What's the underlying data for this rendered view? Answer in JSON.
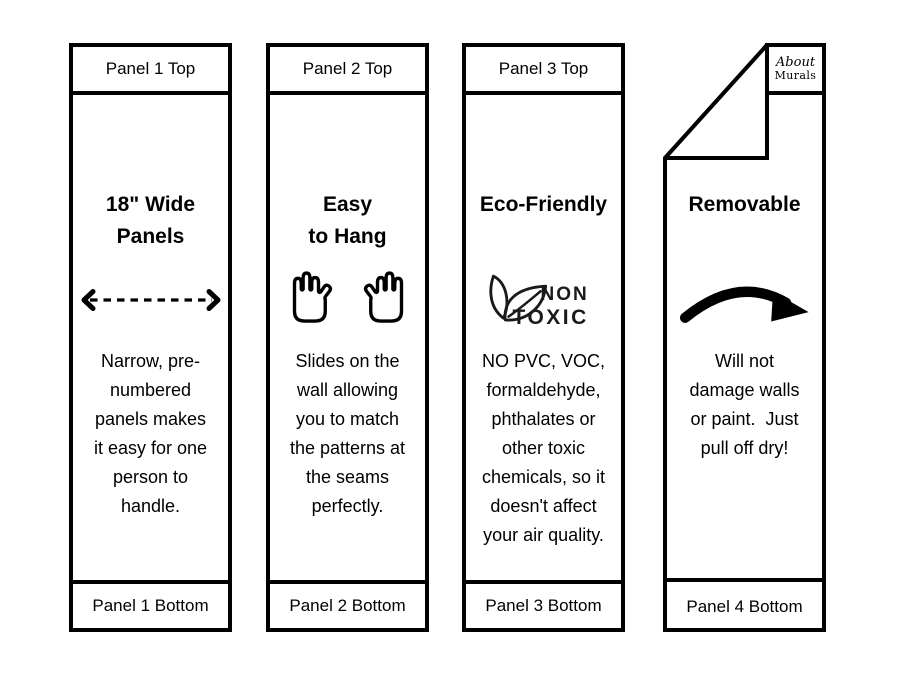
{
  "colors": {
    "ink": "#000000",
    "background": "#ffffff",
    "icon_text": "#1a1a1a"
  },
  "panels": [
    {
      "header": "Panel 1 Top",
      "title": "18\" Wide\nPanels",
      "icon": "dashed-width-arrow-icon",
      "body": "Narrow, pre-\nnumbered\npanels makes\nit easy for one\nperson to\nhandle.",
      "footer": "Panel 1 Bottom"
    },
    {
      "header": "Panel 2 Top",
      "title": "Easy\nto Hang",
      "icon": "two-hands-icon",
      "body": "Slides on the\nwall allowing\nyou to match\nthe patterns at\nthe seams\nperfectly.",
      "footer": "Panel 2 Bottom"
    },
    {
      "header": "Panel 3 Top",
      "title": "Eco-Friendly",
      "icon": "non-toxic-leaf-icon",
      "icon_label_top": "NON",
      "icon_label_bottom": "TOXIC",
      "body": "NO PVC, VOC,\nformaldehyde,\nphthalates or\nother toxic\nchemicals, so it\ndoesn't affect\nyour air quality.",
      "footer": "Panel 3 Bottom"
    },
    {
      "logo_line1": "About",
      "logo_line2": "Murals",
      "title": "Removable",
      "icon": "curved-peel-arrow-icon",
      "body": "Will not\ndamage walls\nor paint.  Just\npull off dry!",
      "footer": "Panel 4 Bottom"
    }
  ]
}
